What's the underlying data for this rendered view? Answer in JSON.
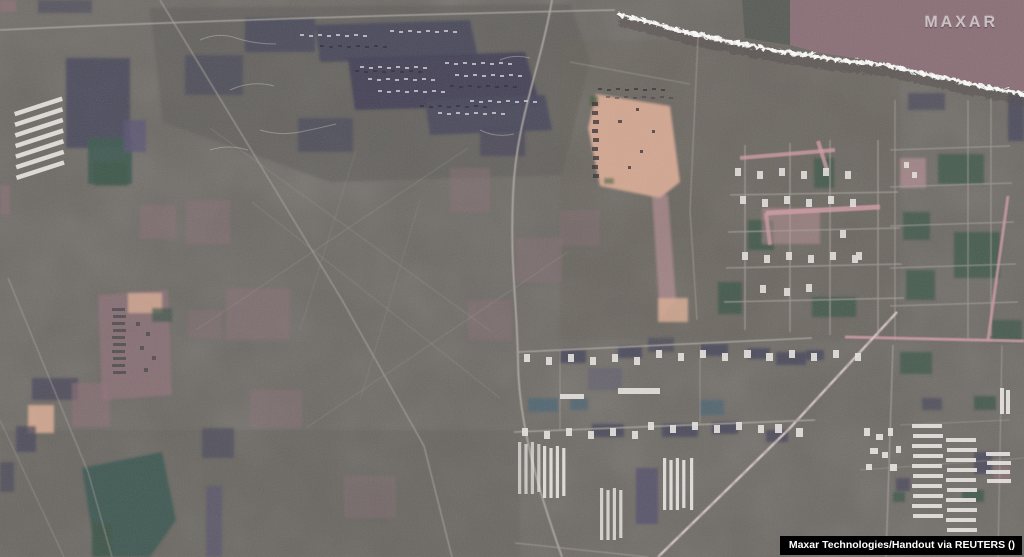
{
  "meta": {
    "type": "satellite-photograph",
    "description": "Maxar satellite view of a large military field camp, dirt staging area, farm villages with white barns and greenhouses, and a dark plowed field along a tree-lined boundary at top right"
  },
  "watermark": {
    "logo": "MAXAR"
  },
  "credit": {
    "text": "Maxar Technologies/Handout via REUTERS ()"
  },
  "colors": {
    "terrain": "#6b6762",
    "terrain_dark": "#5e5b5a",
    "plowed_field": "#8a6f77",
    "camp_slate": "#49485c",
    "slate_light": "#5d5575",
    "field_green": "#3f574b",
    "field_teal": "#3f5a52",
    "patch_mauve": "#8f7179",
    "road_pink": "#cf9ba3",
    "dirt_tan": "#d8ab94",
    "building_white": "#e6e3df",
    "road_light": "#b3aca4",
    "shore_white": "#f2efec",
    "credit_bg": "#000000",
    "credit_text": "#ffffff",
    "logo_text": "#d9d2d5"
  }
}
